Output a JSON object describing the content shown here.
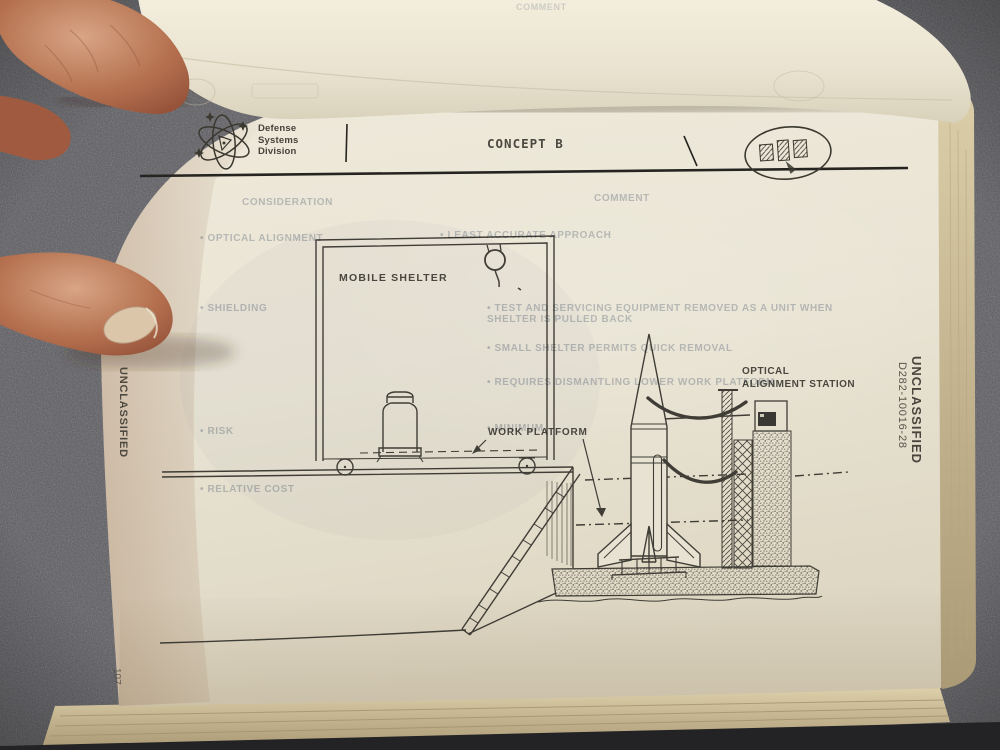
{
  "document": {
    "header": {
      "division_logo_lines": [
        "Defense",
        "Systems",
        "Division"
      ],
      "title": "CONCEPT B"
    },
    "diagram_labels": {
      "mobile_shelter": "MOBILE SHELTER",
      "work_platform": "WORK PLATFORM",
      "optical_line1": "OPTICAL",
      "optical_line2": "ALIGNMENT STATION"
    },
    "margins": {
      "left_classification": "UNCLASSIFIED",
      "right_classification": "UNCLASSIFIED",
      "document_number": "D282-10016-28",
      "page_number": "107"
    },
    "bleedthrough": {
      "curled_page_text": "COMMENT",
      "left_column_header": "CONSIDERATION",
      "right_column_header": "COMMENT",
      "rows": [
        {
          "left": "•  OPTICAL ALIGNMENT",
          "right": "•  LEAST ACCURATE APPROACH"
        },
        {
          "left": "•  SHIELDING",
          "right": "•  TEST AND SERVICING EQUIPMENT REMOVED AS A UNIT WHEN SHELTER IS PULLED BACK"
        },
        {
          "left": "",
          "right": "•  SMALL SHELTER PERMITS QUICK REMOVAL"
        },
        {
          "left": "",
          "right": "•  REQUIRES DISMANTLING LOWER WORK PLATFORM"
        },
        {
          "left": "•  RISK",
          "right": "•  MINIMUM"
        },
        {
          "left": "•  RELATIVE COST",
          "right": ""
        }
      ]
    }
  },
  "colors": {
    "paper": "#e9e4d4",
    "ink": "#32302a",
    "fabric_background": "#5b5b60",
    "ghost_text": "#7e8ba3",
    "skin": "#b97757",
    "page_edges": "#cfc19c"
  }
}
